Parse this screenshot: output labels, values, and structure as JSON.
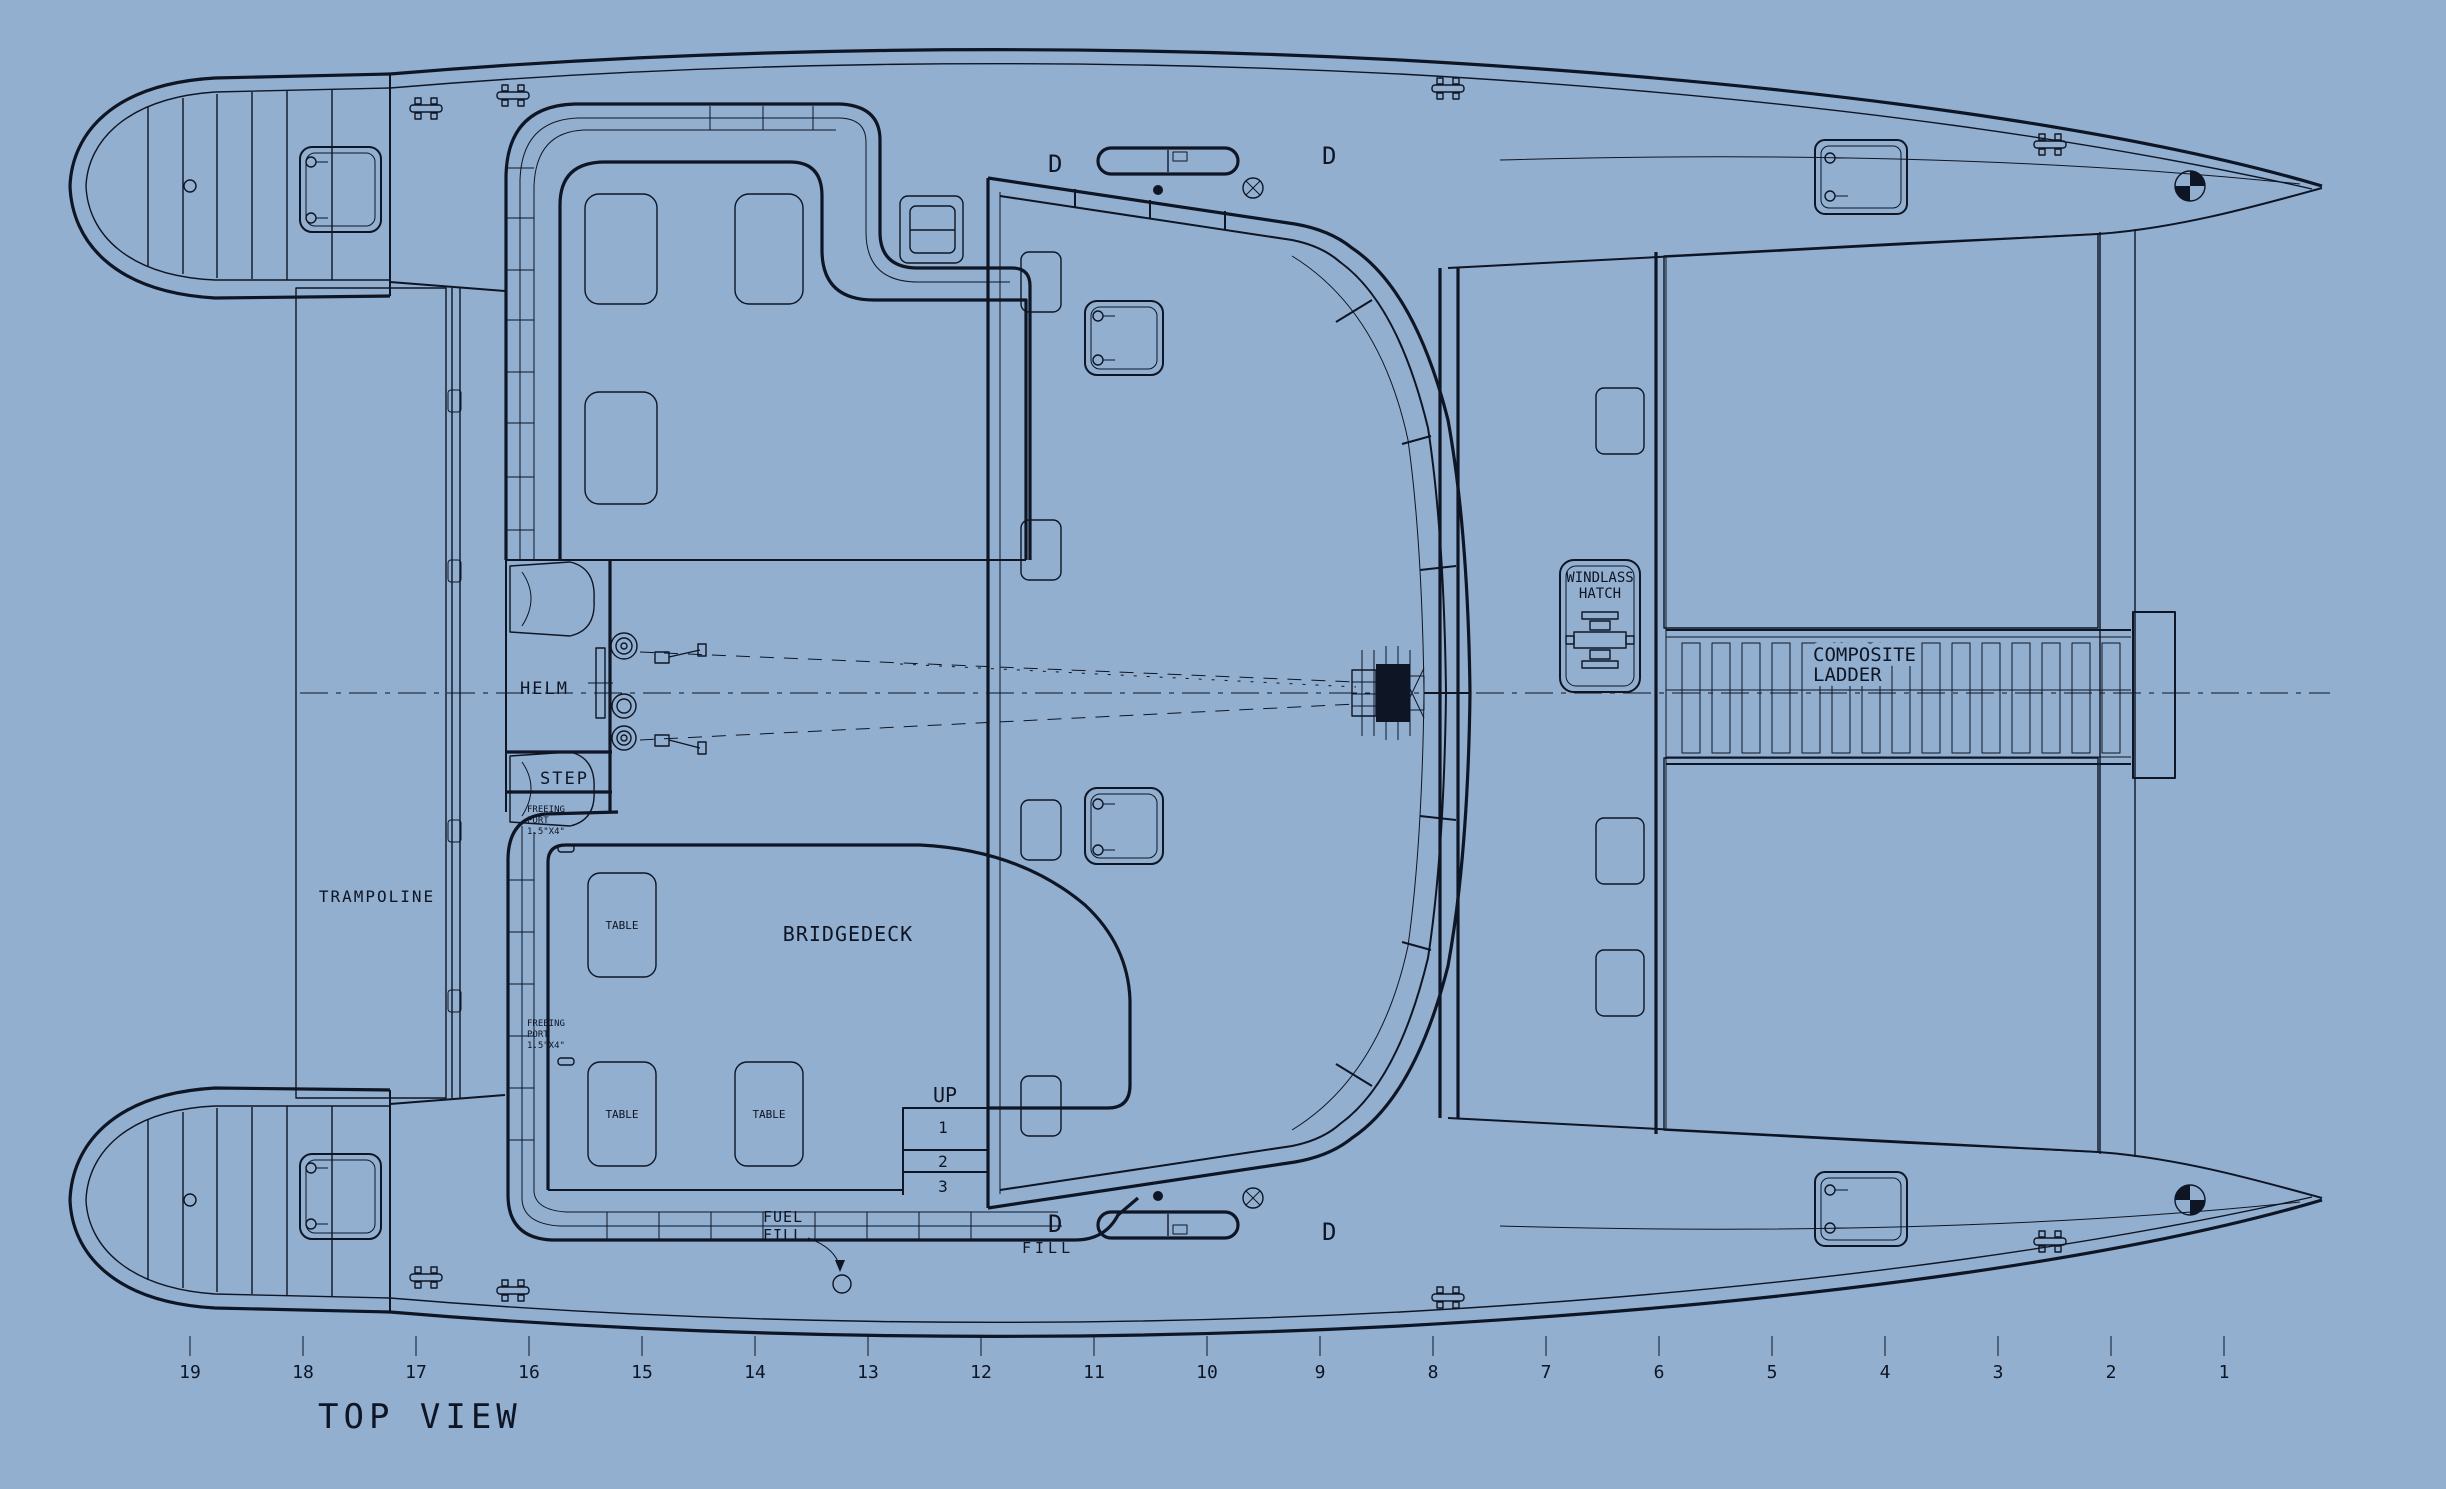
{
  "drawing": {
    "view_title": "TOP VIEW",
    "background_color": "#92afcf",
    "line_color": "#0e1524",
    "labels": {
      "trampoline": "TRAMPOLINE",
      "helm": "HELM",
      "step": "STEP",
      "bridgedeck": "BRIDGEDECK",
      "table": "TABLE",
      "windlass_hatch_line1": "WINDLASS",
      "windlass_hatch_line2": "HATCH",
      "composite_ladder_line1": "COMPOSITE",
      "composite_ladder_line2": "LADDER",
      "fuel_fill_line1": "FUEL",
      "fuel_fill_line2": "FILL",
      "fill": "FILL",
      "up": "UP",
      "step_numbers": [
        "1",
        "2",
        "3"
      ],
      "freeing_port_line1": "FREEING",
      "freeing_port_line2": "PORT",
      "freeing_port_line3": "1.5\"X4\"",
      "d_marker": "D"
    },
    "ruler_stations": [
      "19",
      "18",
      "17",
      "16",
      "15",
      "14",
      "13",
      "12",
      "11",
      "10",
      "9",
      "8",
      "7",
      "6",
      "5",
      "4",
      "3",
      "2",
      "1"
    ]
  }
}
